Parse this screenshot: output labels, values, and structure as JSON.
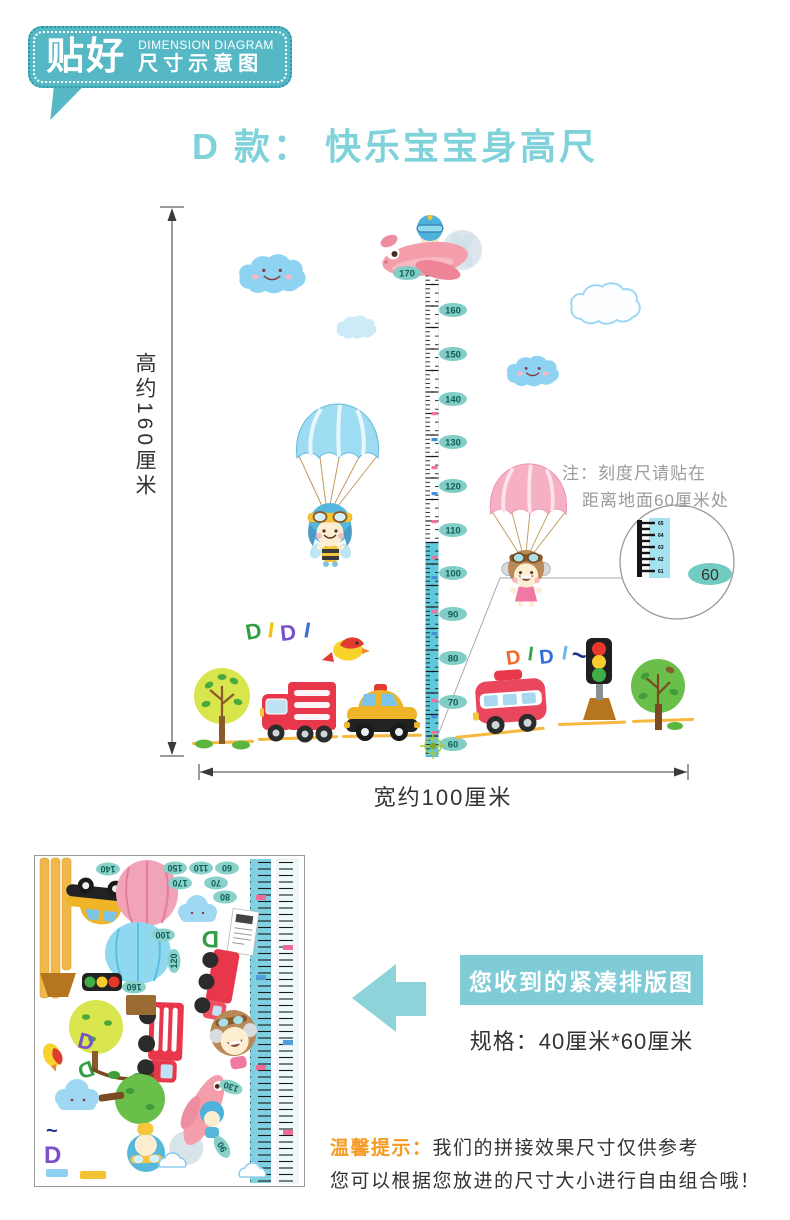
{
  "badge": {
    "brand": "贴好",
    "subtitle_en": "DIMENSION DIAGRAM",
    "subtitle_cn": "尺寸示意图"
  },
  "title": "D 款：  快乐宝宝身高尺",
  "diagram": {
    "height_label": "高约160厘米",
    "width_label": "宽约100厘米",
    "note_line1": "注：刻度尺请贴在",
    "note_line2": "距离地面60厘米处",
    "ruler_labels": [
      "170",
      "160",
      "150",
      "140",
      "130",
      "120",
      "110",
      "100",
      "90",
      "80",
      "70",
      "60"
    ],
    "magnifier": {
      "value": "60",
      "ticks": [
        "65",
        "64",
        "63",
        "62",
        "61"
      ]
    },
    "didi_left": [
      "D",
      "I",
      "D",
      "I"
    ],
    "didi_right": [
      "D",
      "I",
      "D",
      "I",
      "~"
    ]
  },
  "sheet": {
    "labels": [
      "140",
      "150",
      "110",
      "60",
      "170",
      "70",
      "80",
      "100",
      "120",
      "160",
      "130",
      "90"
    ]
  },
  "received": {
    "button_label": "您收到的紧凑排版图",
    "spec": "规格：40厘米*60厘米"
  },
  "tips": {
    "label": "温馨提示：",
    "line1": "我们的拼接效果尺寸仅供参考",
    "line2": "您可以根据您放进的尺寸大小进行自由组合哦！"
  },
  "colors": {
    "teal": "#57b8c5",
    "teal_light": "#7fccd6",
    "title_teal": "#7fd2d9",
    "orange": "#f59a23",
    "ruler_cyan": "#5fc8da",
    "oval": "#82cec6"
  }
}
